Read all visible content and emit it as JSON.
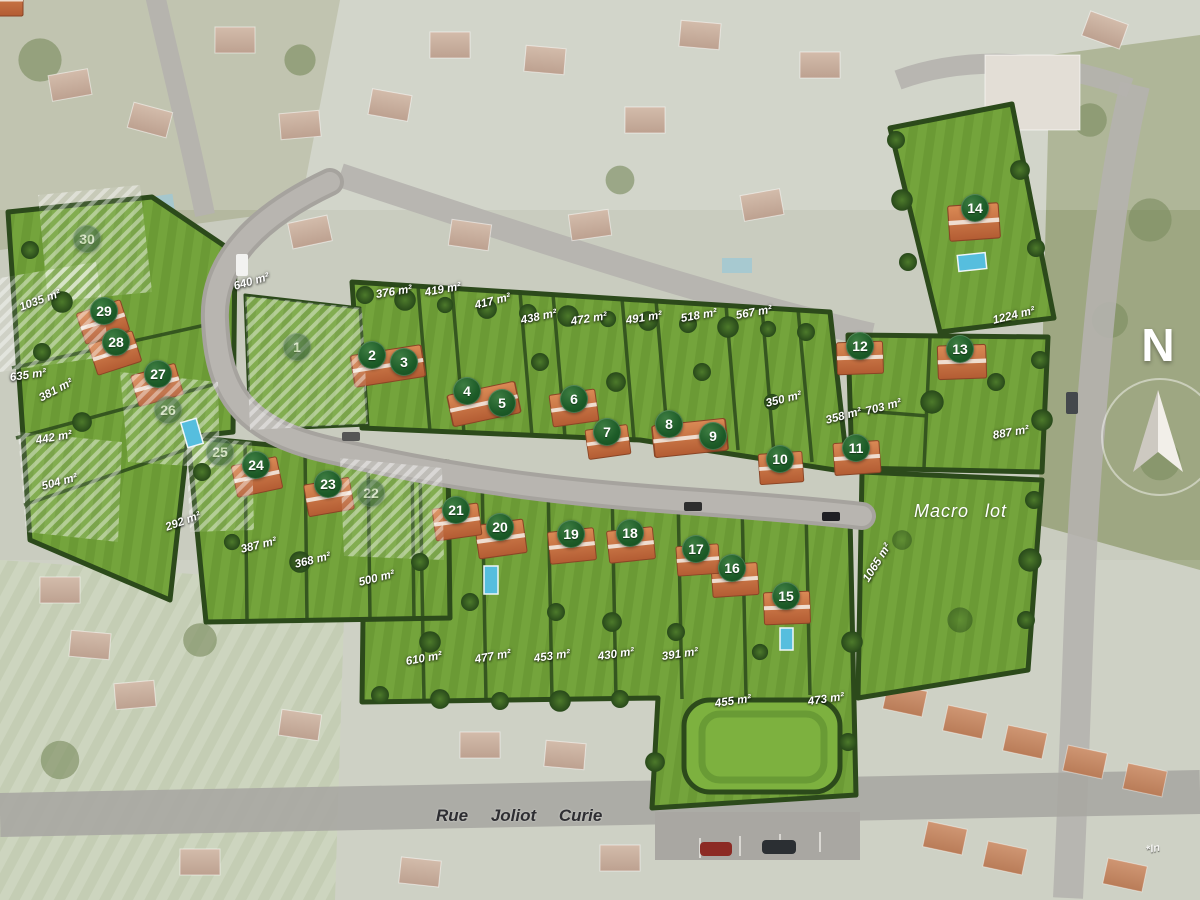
{
  "site_plan": {
    "compass_label": "N",
    "street_label": "Rue Joliot Curie",
    "macro_lot_label": "Macro lot",
    "footnote": "*In",
    "lots": [
      {
        "num": "1",
        "x": 297,
        "y": 347,
        "sold": true
      },
      {
        "num": "2",
        "x": 372,
        "y": 355
      },
      {
        "num": "3",
        "x": 404,
        "y": 362
      },
      {
        "num": "4",
        "x": 467,
        "y": 391
      },
      {
        "num": "5",
        "x": 502,
        "y": 403
      },
      {
        "num": "6",
        "x": 574,
        "y": 399
      },
      {
        "num": "7",
        "x": 607,
        "y": 432
      },
      {
        "num": "8",
        "x": 669,
        "y": 424
      },
      {
        "num": "9",
        "x": 713,
        "y": 436
      },
      {
        "num": "10",
        "x": 780,
        "y": 459
      },
      {
        "num": "11",
        "x": 856,
        "y": 448
      },
      {
        "num": "12",
        "x": 860,
        "y": 346
      },
      {
        "num": "13",
        "x": 960,
        "y": 349
      },
      {
        "num": "14",
        "x": 975,
        "y": 208
      },
      {
        "num": "15",
        "x": 786,
        "y": 596
      },
      {
        "num": "16",
        "x": 732,
        "y": 568
      },
      {
        "num": "17",
        "x": 696,
        "y": 549
      },
      {
        "num": "18",
        "x": 630,
        "y": 533
      },
      {
        "num": "19",
        "x": 571,
        "y": 534
      },
      {
        "num": "20",
        "x": 500,
        "y": 527
      },
      {
        "num": "21",
        "x": 456,
        "y": 510
      },
      {
        "num": "22",
        "x": 371,
        "y": 493,
        "sold": true
      },
      {
        "num": "23",
        "x": 328,
        "y": 484
      },
      {
        "num": "24",
        "x": 256,
        "y": 465
      },
      {
        "num": "25",
        "x": 220,
        "y": 452,
        "sold": true
      },
      {
        "num": "26",
        "x": 168,
        "y": 410,
        "sold": true
      },
      {
        "num": "27",
        "x": 158,
        "y": 374
      },
      {
        "num": "28",
        "x": 116,
        "y": 342
      },
      {
        "num": "29",
        "x": 104,
        "y": 311
      },
      {
        "num": "30",
        "x": 87,
        "y": 239,
        "sold": true
      }
    ],
    "area_labels": [
      {
        "text": "1035 m²",
        "x": 20,
        "y": 302,
        "rot": -20
      },
      {
        "text": "640 m²",
        "x": 234,
        "y": 281,
        "rot": -16
      },
      {
        "text": "376 m²",
        "x": 376,
        "y": 289,
        "rot": -9
      },
      {
        "text": "419 m²",
        "x": 425,
        "y": 287,
        "rot": -10
      },
      {
        "text": "417 m²",
        "x": 475,
        "y": 300,
        "rot": -14
      },
      {
        "text": "438 m²",
        "x": 521,
        "y": 315,
        "rot": -12
      },
      {
        "text": "472 m²",
        "x": 571,
        "y": 316,
        "rot": -9
      },
      {
        "text": "491 m²",
        "x": 626,
        "y": 315,
        "rot": -9
      },
      {
        "text": "518 m²",
        "x": 681,
        "y": 313,
        "rot": -10
      },
      {
        "text": "567 m²",
        "x": 736,
        "y": 310,
        "rot": -10
      },
      {
        "text": "1224 m²",
        "x": 993,
        "y": 315,
        "rot": -14
      },
      {
        "text": "350 m²",
        "x": 766,
        "y": 398,
        "rot": -14
      },
      {
        "text": "703 m²",
        "x": 866,
        "y": 406,
        "rot": -15
      },
      {
        "text": "358 m²",
        "x": 826,
        "y": 415,
        "rot": -15
      },
      {
        "text": "887 m²",
        "x": 993,
        "y": 430,
        "rot": -10
      },
      {
        "text": "635 m²",
        "x": 10,
        "y": 372,
        "rot": -8
      },
      {
        "text": "381 m²",
        "x": 40,
        "y": 393,
        "rot": -28
      },
      {
        "text": "442 m²",
        "x": 36,
        "y": 435,
        "rot": -10
      },
      {
        "text": "504 m²",
        "x": 42,
        "y": 481,
        "rot": -15
      },
      {
        "text": "292 m²",
        "x": 166,
        "y": 522,
        "rot": -20
      },
      {
        "text": "387 m²",
        "x": 241,
        "y": 544,
        "rot": -14
      },
      {
        "text": "368 m²",
        "x": 295,
        "y": 559,
        "rot": -14
      },
      {
        "text": "500 m²",
        "x": 359,
        "y": 577,
        "rot": -14
      },
      {
        "text": "610 m²",
        "x": 406,
        "y": 656,
        "rot": -10
      },
      {
        "text": "477 m²",
        "x": 475,
        "y": 654,
        "rot": -10
      },
      {
        "text": "453 m²",
        "x": 534,
        "y": 653,
        "rot": -8
      },
      {
        "text": "430 m²",
        "x": 598,
        "y": 651,
        "rot": -8
      },
      {
        "text": "391 m²",
        "x": 662,
        "y": 651,
        "rot": -8
      },
      {
        "text": "455 m²",
        "x": 715,
        "y": 698,
        "rot": -8
      },
      {
        "text": "473 m²",
        "x": 808,
        "y": 696,
        "rot": -8
      },
      {
        "text": "1065 m²",
        "x": 866,
        "y": 575,
        "rot": -58
      }
    ]
  }
}
